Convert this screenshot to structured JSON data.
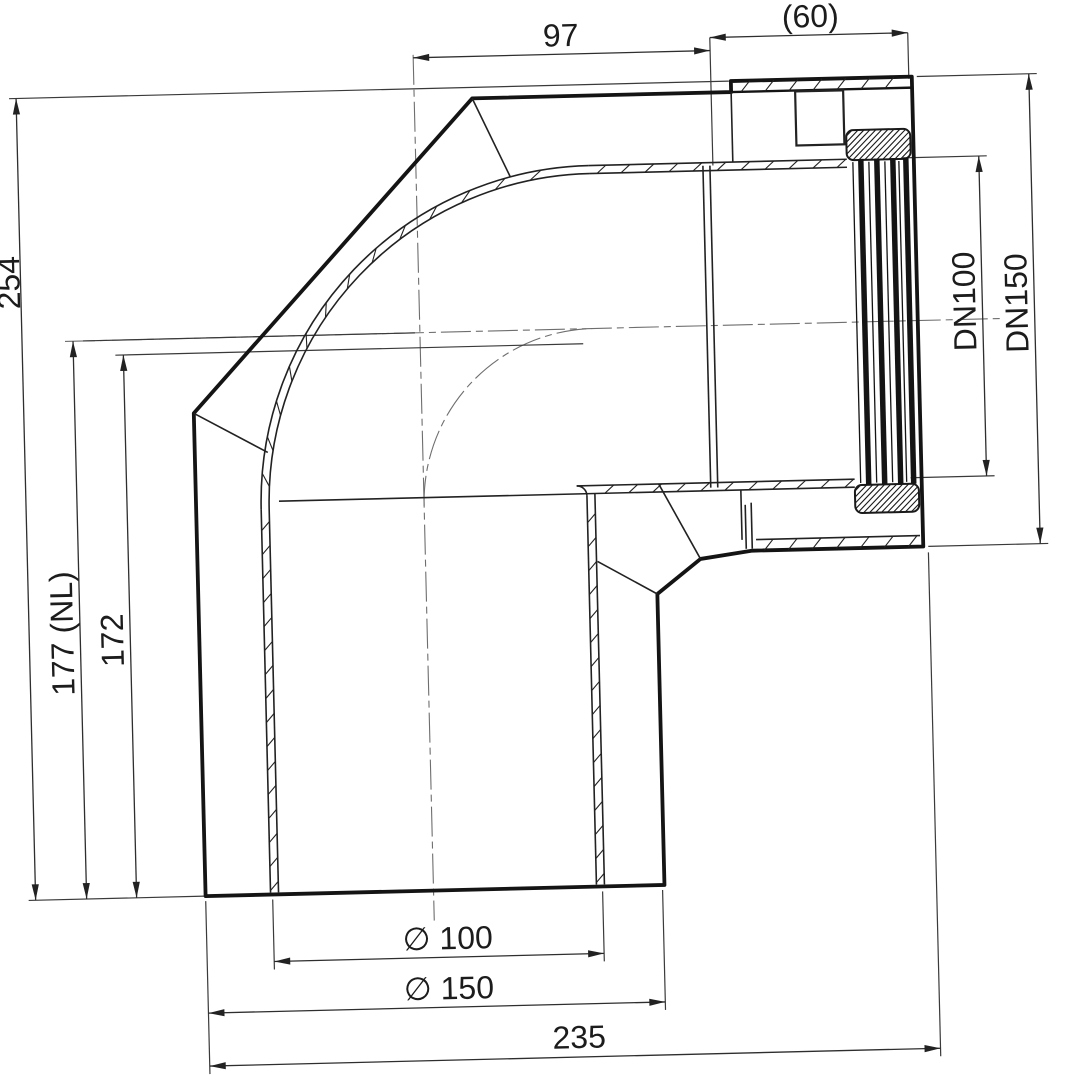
{
  "drawing": {
    "type": "technical-section-drawing",
    "subject": "90-degree concentric flue elbow, sectional view with dimensions",
    "dims": {
      "top_leg_length": "97",
      "socket_depth": "(60)",
      "total_height": "254",
      "nominal_length": "177 (NL)",
      "install_length": "172",
      "inner_nominal": "DN100",
      "outer_nominal": "DN150",
      "inner_diameter": "∅ 100",
      "outer_diameter": "∅ 150",
      "total_width": "235"
    },
    "colors": {
      "background": "#ffffff",
      "outline": "#141414",
      "thin_line": "#222222",
      "dimension_line": "#353535",
      "centerline": "#6e6e6e"
    }
  }
}
